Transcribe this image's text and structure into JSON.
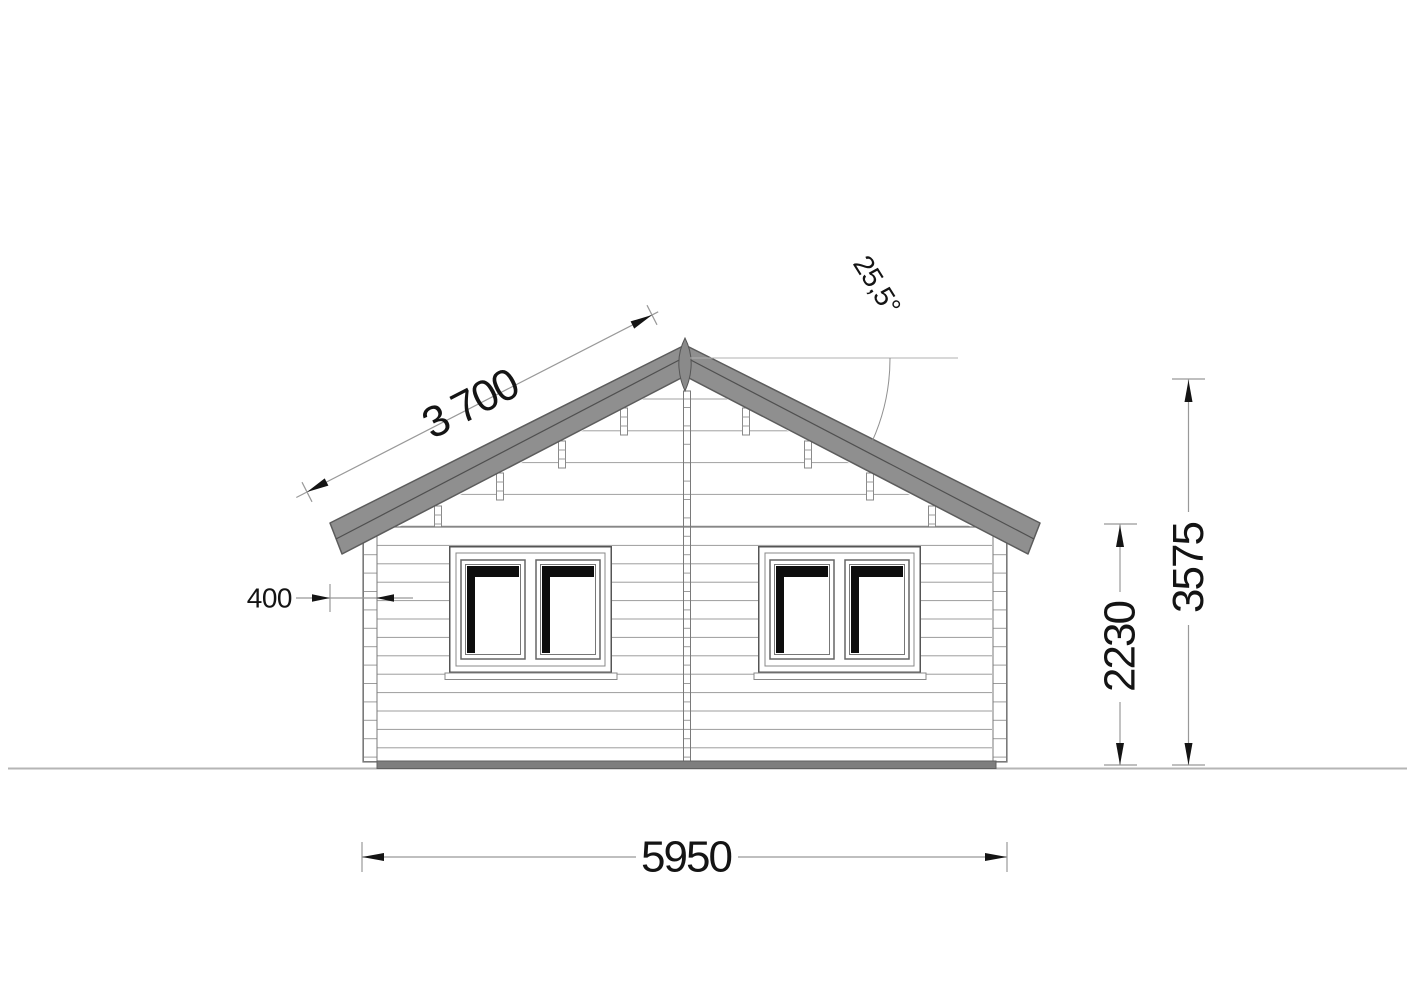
{
  "drawing": {
    "dimension_labels": {
      "roof_slope_length": "3 700",
      "roof_angle": "25,5°",
      "eave_overhang": "400",
      "wall_height": "2230",
      "total_height": "3575",
      "overall_width": "5950"
    },
    "colors": {
      "roof_fill": "#8f8f8f",
      "roof_edge": "#5c5c5c",
      "siding_line": "#9c9c9c",
      "outline": "#6a6a6a",
      "base_strip": "#7e7e7e",
      "window_shadow": "#0d0d0d",
      "dimension_line": "#999999",
      "dimension_text": "#141414",
      "ground_line": "#b5b5b5"
    }
  }
}
